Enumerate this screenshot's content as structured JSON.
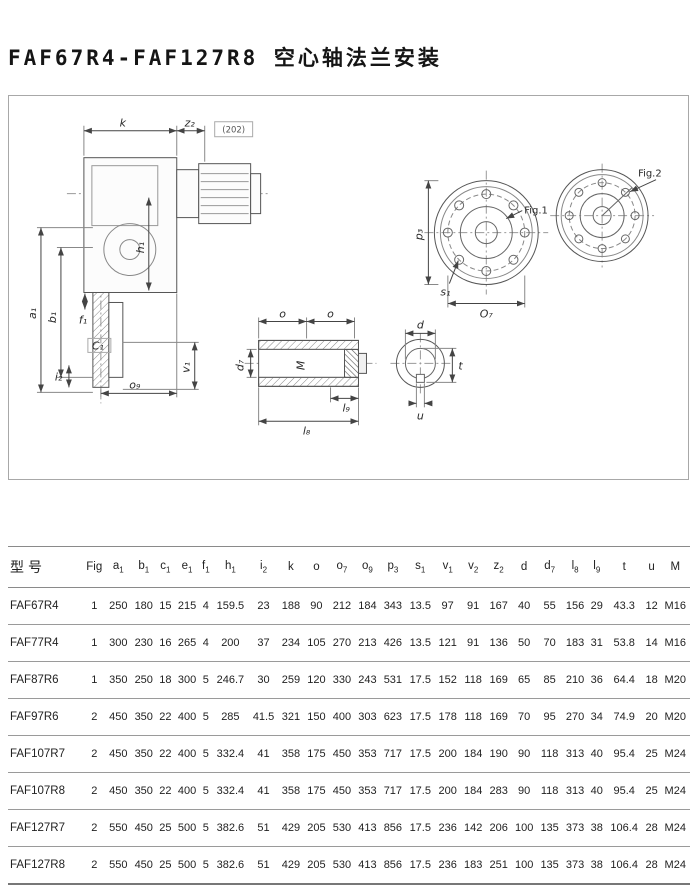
{
  "page": {
    "title": "FAF67R4-FAF127R8 空心轴法兰安装"
  },
  "drawing": {
    "labels": {
      "k": "k",
      "z2": "z₂",
      "note": "(202)",
      "a1": "a₁",
      "b1": "b₁",
      "h1": "h₁",
      "v1": "v₁",
      "f1": "f₁",
      "c1": "C₁",
      "i2": "i₂",
      "o9": "o₉",
      "p3": "p₃",
      "fig1": "Fig.1",
      "fig2": "Fig.2",
      "s1": "s₁",
      "o7": "O₇",
      "o_left": "o",
      "o_right": "o",
      "d7": "d₇",
      "m": "M",
      "l9": "l₉",
      "l8": "l₈",
      "d": "d",
      "t": "t",
      "u": "u"
    }
  },
  "table": {
    "columns": [
      {
        "id": "model",
        "b": "型号",
        "s": ""
      },
      {
        "id": "fig",
        "b": "Fig",
        "s": ""
      },
      {
        "id": "a1",
        "b": "a",
        "s": "1"
      },
      {
        "id": "b1",
        "b": "b",
        "s": "1"
      },
      {
        "id": "c1",
        "b": "c",
        "s": "1"
      },
      {
        "id": "e1",
        "b": "e",
        "s": "1"
      },
      {
        "id": "f1",
        "b": "f",
        "s": "1"
      },
      {
        "id": "h1",
        "b": "h",
        "s": "1"
      },
      {
        "id": "i2",
        "b": "i",
        "s": "2"
      },
      {
        "id": "k",
        "b": "k",
        "s": ""
      },
      {
        "id": "o",
        "b": "o",
        "s": ""
      },
      {
        "id": "o7",
        "b": "o",
        "s": "7"
      },
      {
        "id": "o9",
        "b": "o",
        "s": "9"
      },
      {
        "id": "p3",
        "b": "p",
        "s": "3"
      },
      {
        "id": "s1",
        "b": "s",
        "s": "1"
      },
      {
        "id": "v1",
        "b": "v",
        "s": "1"
      },
      {
        "id": "v2",
        "b": "v",
        "s": "2"
      },
      {
        "id": "z2",
        "b": "z",
        "s": "2"
      },
      {
        "id": "d",
        "b": "d",
        "s": ""
      },
      {
        "id": "d7",
        "b": "d",
        "s": "7"
      },
      {
        "id": "l8",
        "b": "l",
        "s": "8"
      },
      {
        "id": "l9",
        "b": "l",
        "s": "9"
      },
      {
        "id": "t",
        "b": "t",
        "s": ""
      },
      {
        "id": "u",
        "b": "u",
        "s": ""
      },
      {
        "id": "M",
        "b": "M",
        "s": ""
      }
    ],
    "rows": [
      [
        "FAF67R4",
        1,
        250,
        180,
        15,
        215,
        4,
        159.5,
        23,
        188,
        90,
        212,
        184,
        343,
        13.5,
        97,
        91,
        167,
        40,
        55,
        156,
        29,
        43.3,
        12,
        "M16"
      ],
      [
        "FAF77R4",
        1,
        300,
        230,
        16,
        265,
        4,
        200,
        37,
        234,
        105,
        270,
        213,
        426,
        13.5,
        121,
        91,
        136,
        50,
        70,
        183,
        31,
        53.8,
        14,
        "M16"
      ],
      [
        "FAF87R6",
        1,
        350,
        250,
        18,
        300,
        5,
        246.7,
        30,
        259,
        120,
        330,
        243,
        531,
        17.5,
        152,
        118,
        169,
        65,
        85,
        210,
        36,
        64.4,
        18,
        "M20"
      ],
      [
        "FAF97R6",
        2,
        450,
        350,
        22,
        400,
        5,
        285,
        41.5,
        321,
        150,
        400,
        303,
        623,
        17.5,
        178,
        118,
        169,
        70,
        95,
        270,
        34,
        74.9,
        20,
        "M20"
      ],
      [
        "FAF107R7",
        2,
        450,
        350,
        22,
        400,
        5,
        332.4,
        41,
        358,
        175,
        450,
        353,
        717,
        17.5,
        200,
        184,
        190,
        90,
        118,
        313,
        40,
        95.4,
        25,
        "M24"
      ],
      [
        "FAF107R8",
        2,
        450,
        350,
        22,
        400,
        5,
        332.4,
        41,
        358,
        175,
        450,
        353,
        717,
        17.5,
        200,
        184,
        283,
        90,
        118,
        313,
        40,
        95.4,
        25,
        "M24"
      ],
      [
        "FAF127R7",
        2,
        550,
        450,
        25,
        500,
        5,
        382.6,
        51,
        429,
        205,
        530,
        413,
        856,
        17.5,
        236,
        142,
        206,
        100,
        135,
        373,
        38,
        106.4,
        28,
        "M24"
      ],
      [
        "FAF127R8",
        2,
        550,
        450,
        25,
        500,
        5,
        382.6,
        51,
        429,
        205,
        530,
        413,
        856,
        17.5,
        236,
        183,
        251,
        100,
        135,
        373,
        38,
        106.4,
        28,
        "M24"
      ]
    ]
  }
}
